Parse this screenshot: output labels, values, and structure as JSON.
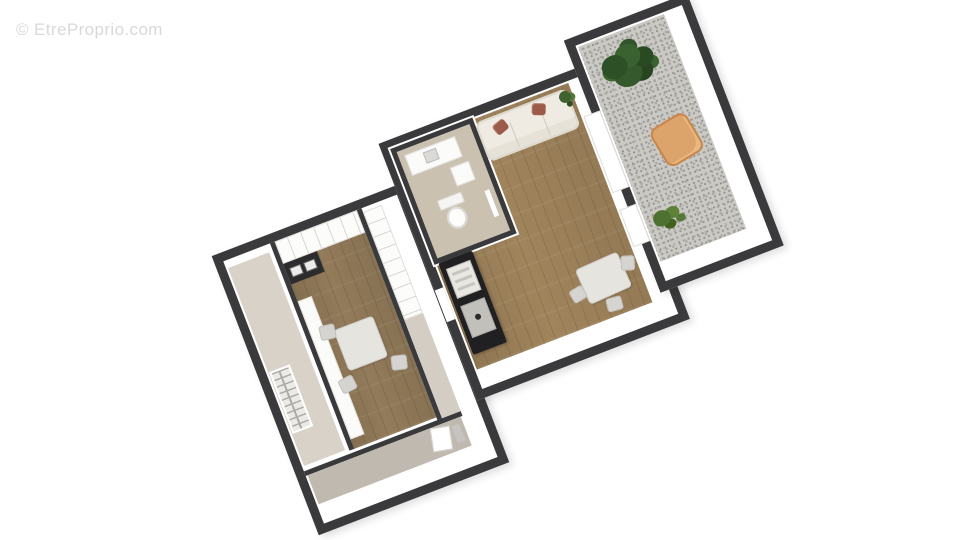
{
  "watermark": {
    "text": "© EtreProprio.com"
  },
  "palette": {
    "background": "#ffffff",
    "wall": "#3a3a3c",
    "wood_floor": "#a0845c",
    "terrace_floor": "#cbc9c4",
    "bath_floor": "#cbc1b1",
    "entry_floor": "#d8d2c8",
    "corridor_floor": "#d3cdc3",
    "balcony_floor": "#c0b9af",
    "sofa": "#efebe3",
    "pillow": "#9c5a49",
    "counter_black": "#202023",
    "chair_terrace": "#dca36a",
    "plant_dark": "#2e5027",
    "plant_light": "#4e7030"
  },
  "plan": {
    "type": "3d-floorplan",
    "rotation_deg": -21,
    "rooms": [
      {
        "name": "entry-hall",
        "floor": "beige",
        "features": [
          "window-grille"
        ]
      },
      {
        "name": "kitchen-dining",
        "floor": "wood",
        "features": [
          "shelf-unit",
          "appliance-cabinet",
          "white-counter",
          "square-table",
          "three-chairs"
        ]
      },
      {
        "name": "hallway-storage",
        "floor": "greige",
        "features": [
          "wardrobe-shelves"
        ]
      },
      {
        "name": "bathroom",
        "floor": "beige",
        "features": [
          "sink-counter",
          "washer",
          "toilet"
        ]
      },
      {
        "name": "living-room",
        "floor": "wood",
        "features": [
          "sofa-with-pillows",
          "kitchenette-counter",
          "sink",
          "cooktop",
          "dining-table",
          "chairs",
          "small-plant",
          "sliding-window"
        ]
      },
      {
        "name": "terrace",
        "floor": "speckled-gray",
        "features": [
          "large-plant",
          "lounge-chair",
          "small-plant"
        ]
      },
      {
        "name": "rear-balcony",
        "floor": "greige",
        "features": [
          "door"
        ]
      }
    ]
  }
}
